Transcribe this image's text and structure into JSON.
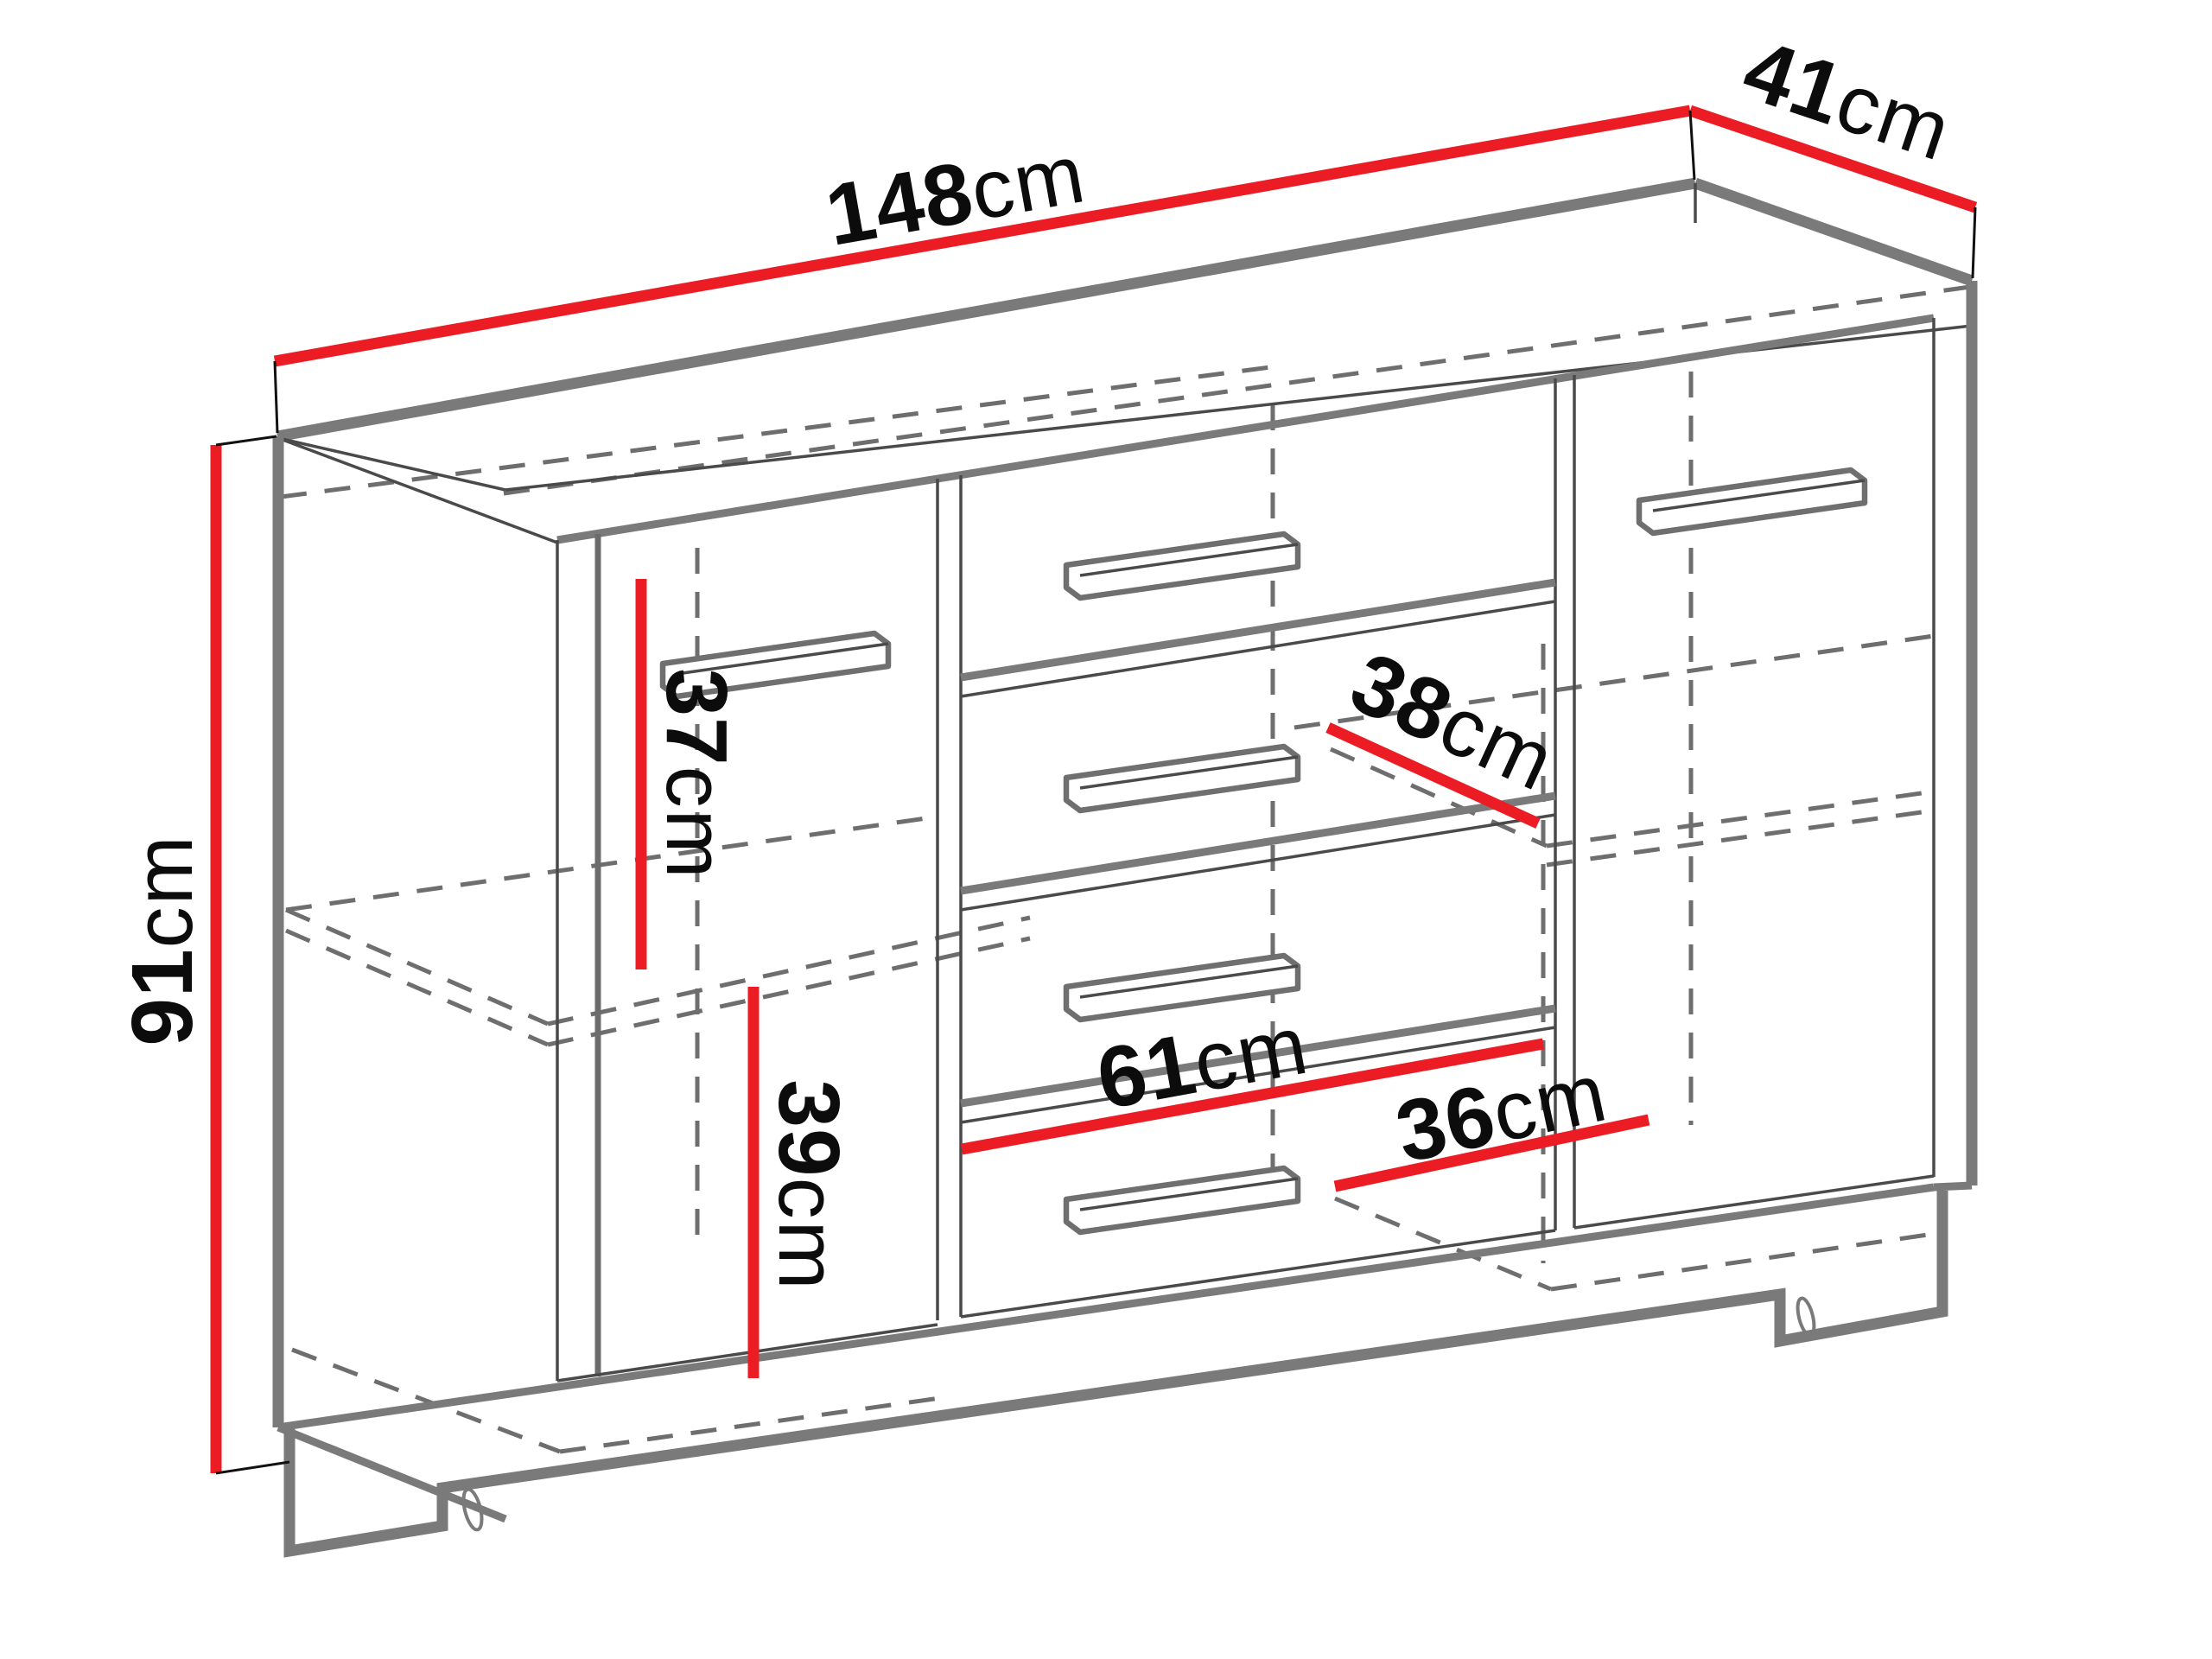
{
  "diagram": {
    "type": "furniture-dimension-diagram",
    "subject": "sideboard-cabinet-line-drawing",
    "unit": "cm",
    "colors": {
      "dimension_line": "#ec1c24",
      "outline": "#7a7a7a",
      "hidden_line": "#6e6e6e",
      "label_text": "#0c0c0c",
      "background": "#ffffff"
    },
    "dimensions": {
      "width": {
        "value": "148",
        "unit": "cm"
      },
      "depth": {
        "value": "41",
        "unit": "cm"
      },
      "height": {
        "value": "91",
        "unit": "cm"
      },
      "left_upper_compartment_height": {
        "value": "37",
        "unit": "cm"
      },
      "left_lower_compartment_height": {
        "value": "39",
        "unit": "cm"
      },
      "interior_shelf_depth": {
        "value": "38",
        "unit": "cm"
      },
      "middle_section_width": {
        "value": "61",
        "unit": "cm"
      },
      "right_compartment_width": {
        "value": "36",
        "unit": "cm"
      }
    }
  }
}
